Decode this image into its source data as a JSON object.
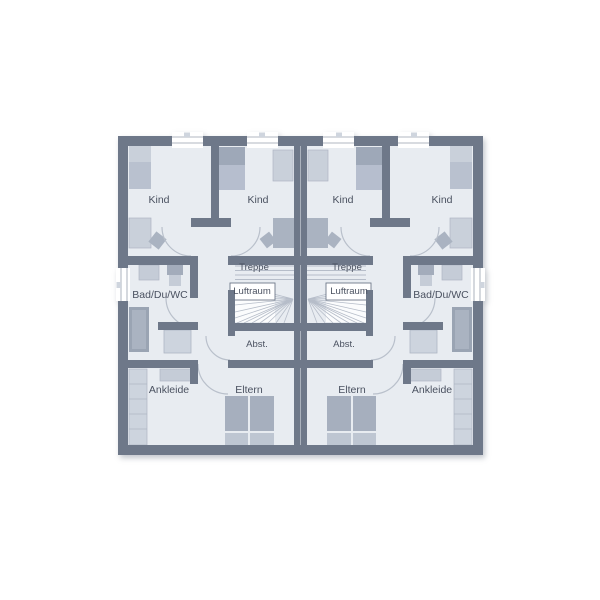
{
  "floor_plan": {
    "left_unit": {
      "rooms": [
        {
          "label": "Kind"
        },
        {
          "label": "Kind"
        },
        {
          "label": "Bad/Du/WC"
        },
        {
          "label": "Treppe"
        },
        {
          "label": "Luftraum"
        },
        {
          "label": "Abst."
        },
        {
          "label": "Ankleide"
        },
        {
          "label": "Eltern"
        }
      ]
    },
    "right_unit": {
      "rooms": [
        {
          "label": "Kind"
        },
        {
          "label": "Kind"
        },
        {
          "label": "Bad/Du/WC"
        },
        {
          "label": "Treppe"
        },
        {
          "label": "Luftraum"
        },
        {
          "label": "Abst."
        },
        {
          "label": "Ankleide"
        },
        {
          "label": "Eltern"
        }
      ]
    },
    "colors": {
      "wall": "#6e7889",
      "floor": "#e8ecf1",
      "furniture_light": "#cdd4de",
      "furniture_mid": "#b4bdca",
      "furniture_dark": "#9aa4b4",
      "stair_line": "#b6bdc9",
      "door_arc": "#b9c0cb",
      "label_text": "#4a5160",
      "window_frame": "#97a0ad",
      "void_white": "#ffffff"
    }
  }
}
